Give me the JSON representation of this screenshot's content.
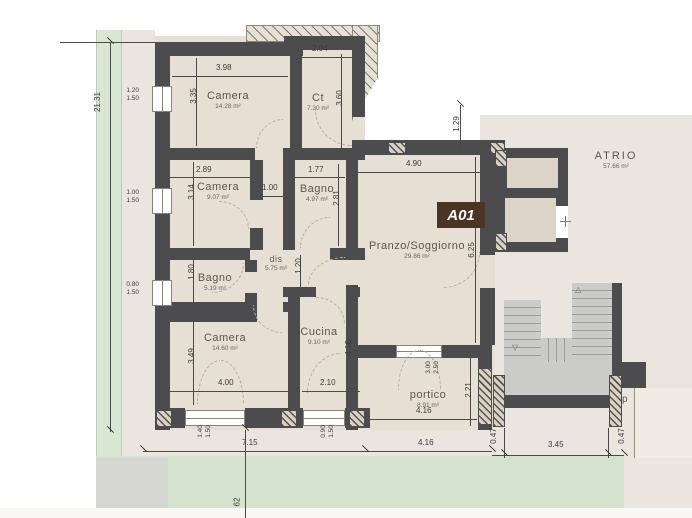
{
  "unit": {
    "badge": "A01"
  },
  "rooms": {
    "camera1": {
      "name": "Camera",
      "area": "14.28 m²"
    },
    "ct": {
      "name": "Ct",
      "area": "7.30 m²"
    },
    "camera2": {
      "name": "Camera",
      "area": "9.07 m²"
    },
    "bagno1": {
      "name": "Bagno",
      "area": "4.97 m²"
    },
    "dis": {
      "name": "dis",
      "area": "5.75 m²"
    },
    "bagno2": {
      "name": "Bagno",
      "area": "5.19 m²"
    },
    "camera3": {
      "name": "Camera",
      "area": "14.60 m²"
    },
    "cucina": {
      "name": "Cucina",
      "area": "9.10 m²"
    },
    "soggiorno": {
      "name": "Pranzo/Soggiorno",
      "area": "29.86 m²"
    },
    "portico": {
      "name": "portico",
      "area": "8.91 m²"
    },
    "atrio": {
      "name": "ATRIO",
      "area": "57.66 m²"
    }
  },
  "dims": {
    "d398": "3.98",
    "d204": "2.04",
    "d335": "3.35",
    "d360": "3.60",
    "d289": "2.89",
    "d314": "3.14",
    "d100": "1.00",
    "d177": "1.77",
    "d281": "2.81",
    "d490": "4.90",
    "d129": "1.29",
    "d625": "6.25",
    "d180": "1.80",
    "d120": "1.20",
    "d349": "3.49",
    "d400": "4.00",
    "d210": "2.10",
    "d416a": "4.16",
    "d221": "2.21",
    "d416b": "4.16",
    "d715": "7.15",
    "d416c": "4.16",
    "d345": "3.45",
    "d047a": "0.47",
    "d047b": "0.47",
    "d2131": "21.31",
    "d62": "62"
  },
  "windows": {
    "w1": {
      "a": "1.20",
      "b": "1.50"
    },
    "w2": {
      "a": "1.00",
      "b": "1.50"
    },
    "w3": {
      "a": "0.80",
      "b": "1.50"
    },
    "w4": {
      "a": "1.40",
      "b": "1.50"
    },
    "w5": {
      "a": "0.90",
      "b": "1.50"
    },
    "w6": {
      "a": "3.00",
      "b": "2.50"
    }
  },
  "neighbor": {
    "label": "p"
  },
  "icons": {
    "stair_arrow_down": "▽",
    "stair_arrow_up": "△"
  },
  "colors": {
    "wall": "#4c4c4e",
    "floor": "#e6dfd4",
    "outside": "#eae6df",
    "green_strip": "#d8e6d2",
    "lawn": "#d3e3cd",
    "stairs": "#cbcbc9",
    "badge_bg": "#4a3424",
    "badge_fg": "#ffffff",
    "shaft_cell": "#dcd4c6"
  }
}
